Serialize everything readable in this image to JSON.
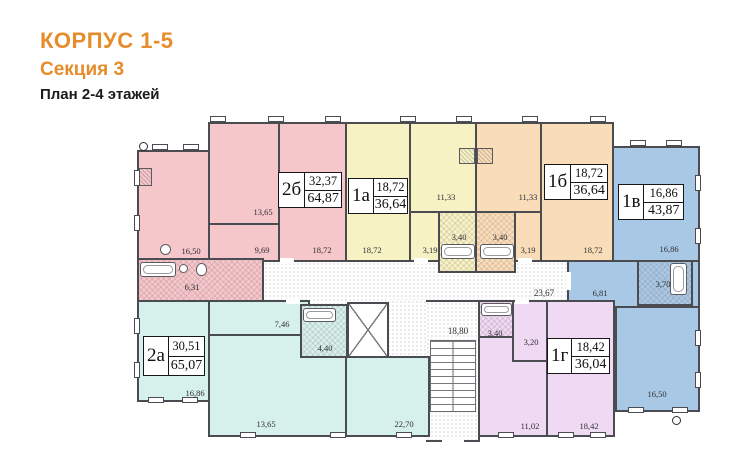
{
  "header": {
    "title": "КОРПУС 1-5",
    "subtitle": "Секция 3",
    "caption": "План 2-4 этажей",
    "accent_color": "#e78c2a"
  },
  "plan": {
    "corridor_area": "23,67",
    "staircase_area": "18,80",
    "wall_color": "#4b4b52",
    "apartments": [
      {
        "id": "2б",
        "living": "32,37",
        "total": "64,87",
        "color": "#f5c6ca",
        "rooms": [
          "16,50",
          "13,65",
          "9,69",
          "18,72",
          "6,31"
        ]
      },
      {
        "id": "1а",
        "living": "18,72",
        "total": "36,64",
        "color": "#f6f2c4",
        "rooms": [
          "18,72",
          "11,33",
          "3,19",
          "3,40"
        ]
      },
      {
        "id": "1б",
        "living": "18,72",
        "total": "36,64",
        "color": "#f9ddb8",
        "rooms": [
          "18,72",
          "11,33",
          "3,19",
          "3,40"
        ]
      },
      {
        "id": "1в",
        "living": "16,86",
        "total": "43,87",
        "color": "#a9c8e6",
        "rooms": [
          "16,86",
          "6,81",
          "3,70",
          "16,50"
        ]
      },
      {
        "id": "2а",
        "living": "30,51",
        "total": "65,07",
        "color": "#d6f1ec",
        "rooms": [
          "16,86",
          "7,46",
          "4,40",
          "13,65",
          "22,70"
        ]
      },
      {
        "id": "1г",
        "living": "18,42",
        "total": "36,04",
        "color": "#f0daf3",
        "rooms": [
          "3,40",
          "3,20",
          "11,02",
          "18,42"
        ]
      }
    ]
  }
}
